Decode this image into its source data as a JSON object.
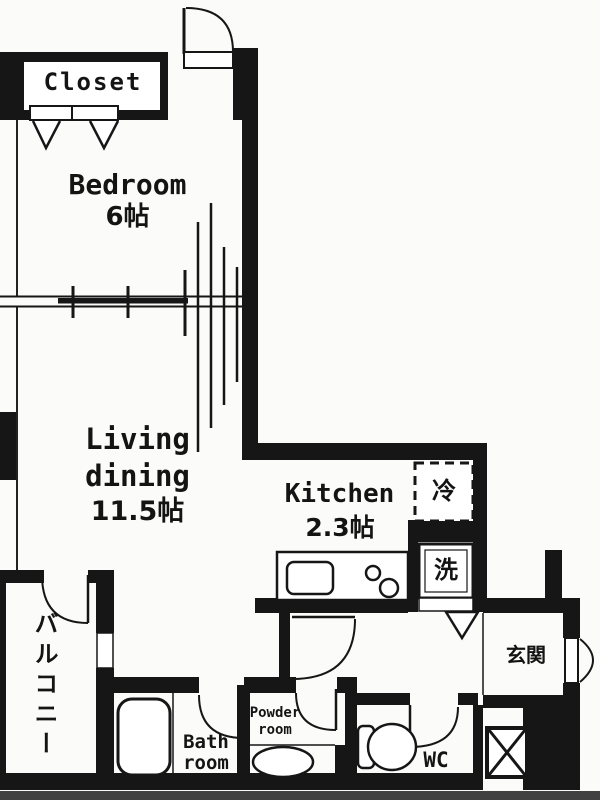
{
  "floorplan": {
    "closet": {
      "label": "Closet"
    },
    "bedroom": {
      "name": "Bedroom",
      "size": "6帖"
    },
    "living": {
      "line1": "Living",
      "line2": "dining",
      "size": "11.5帖"
    },
    "kitchen": {
      "name": "Kitchen",
      "size": "2.3帖"
    },
    "refrigerator": {
      "label": "冷"
    },
    "washer": {
      "label": "洗"
    },
    "entrance": {
      "label": "玄関"
    },
    "balcony": {
      "label": "バルコニー"
    },
    "bathroom": {
      "line1": "Bath",
      "line2": "room"
    },
    "powder_room": {
      "line1": "Powder",
      "line2": "room"
    },
    "wc": {
      "label": "WC"
    },
    "colors": {
      "wall": "#161616",
      "background": "#fbfbfa",
      "photo_strip": "#414141"
    }
  }
}
